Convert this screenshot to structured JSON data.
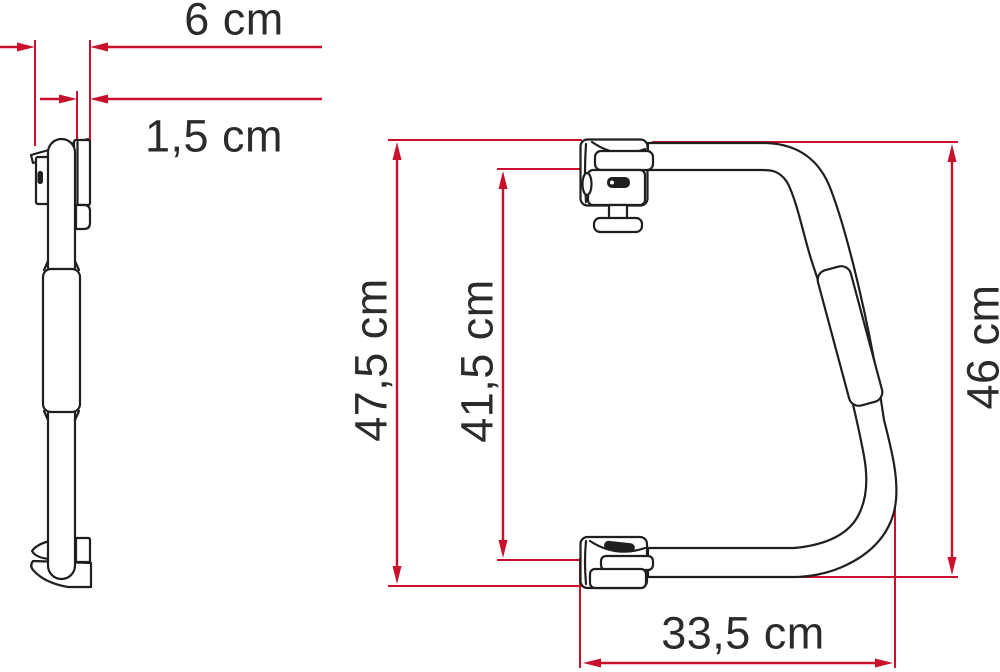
{
  "dimensions": [
    {
      "id": "mount-depth",
      "label": "6 cm",
      "value": 6,
      "unit": "cm",
      "orientation": "horizontal"
    },
    {
      "id": "hook-thickness",
      "label": "1,5 cm",
      "value": 1.5,
      "unit": "cm",
      "orientation": "horizontal"
    },
    {
      "id": "overall-height",
      "label": "47,5 cm",
      "value": 47.5,
      "unit": "cm",
      "orientation": "vertical"
    },
    {
      "id": "inner-height",
      "label": "41,5 cm",
      "value": 41.5,
      "unit": "cm",
      "orientation": "vertical"
    },
    {
      "id": "handle-height",
      "label": "46 cm",
      "value": 46,
      "unit": "cm",
      "orientation": "vertical"
    },
    {
      "id": "bottom-width",
      "label": "33,5 cm",
      "value": 33.5,
      "unit": "cm",
      "orientation": "horizontal"
    }
  ],
  "colors": {
    "dimension_lines": "#c9112b",
    "outline": "#1f1f1d",
    "background": "#ffffff",
    "label_text": "#2b2b2b"
  }
}
